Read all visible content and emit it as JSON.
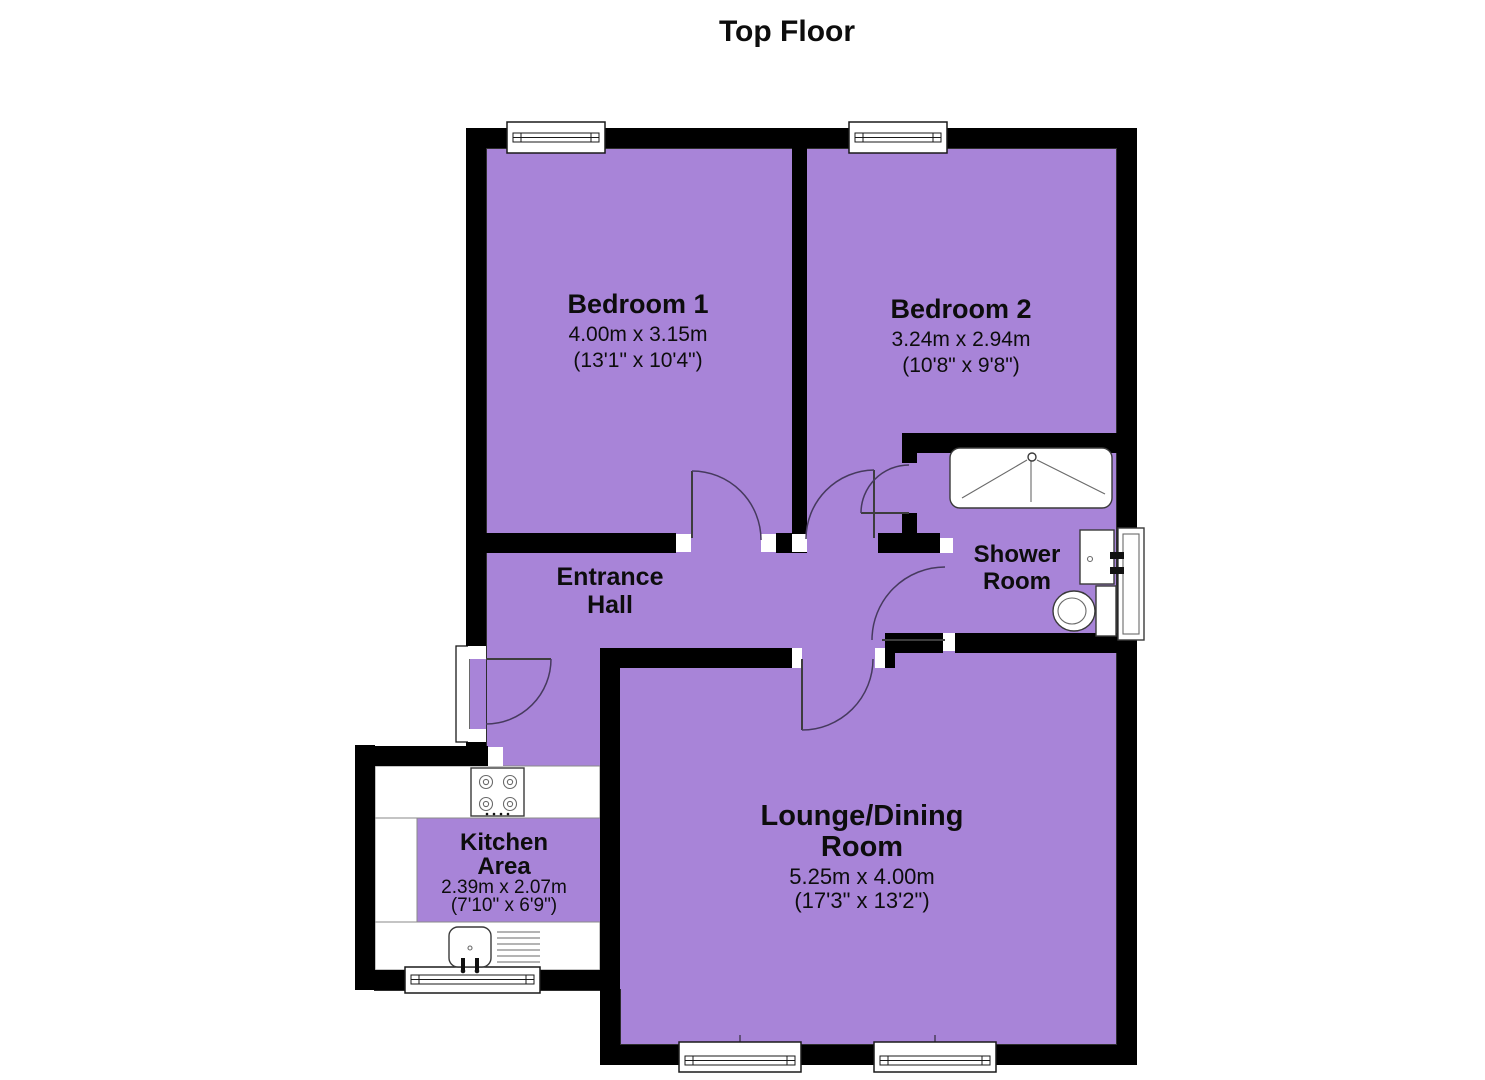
{
  "title": "Top Floor",
  "colors": {
    "floor": "#a884d8",
    "wall": "#000000"
  },
  "rooms": {
    "bedroom1": {
      "name": "Bedroom 1",
      "dim_metric": "4.00m x 3.15m",
      "dim_imperial": "(13'1\" x 10'4\")"
    },
    "bedroom2": {
      "name": "Bedroom 2",
      "dim_metric": "3.24m x 2.94m",
      "dim_imperial": "(10'8\" x 9'8\")"
    },
    "entrance_hall": {
      "name1": "Entrance",
      "name2": "Hall"
    },
    "shower_room": {
      "name1": "Shower",
      "name2": "Room"
    },
    "kitchen": {
      "name1": "Kitchen",
      "name2": "Area",
      "dim_metric": "2.39m x 2.07m",
      "dim_imperial": "(7'10\" x 6'9\")"
    },
    "lounge": {
      "name1": "Lounge/Dining",
      "name2": "Room",
      "dim_metric": "5.25m x 4.00m",
      "dim_imperial": "(17'3\" x 13'2\")"
    }
  },
  "fixtures": [
    "shower-tray",
    "washbasin",
    "toilet",
    "radiator",
    "hob",
    "kitchen-sink",
    "windows",
    "doors"
  ]
}
